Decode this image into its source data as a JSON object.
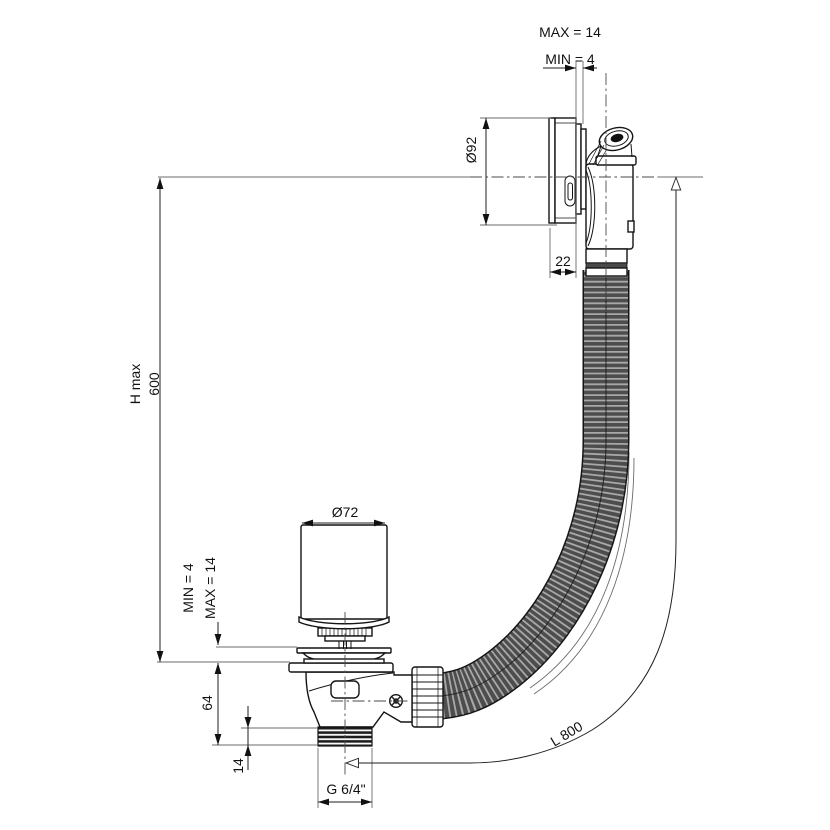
{
  "drawing": {
    "type": "technical-dimension-drawing",
    "background": "#ffffff",
    "line_color": "#141414",
    "dimension_line_color": "#1f1f1f",
    "hose_dark_color": "#4d4d4d",
    "hose_rib_color": "#a8a8a8"
  },
  "dimensions": {
    "overflow_wall_max": "MAX = 14",
    "overflow_wall_min": "MIN = 4",
    "overflow_diameter": "Ø92",
    "overflow_depth": "22",
    "height_max_label": "H max",
    "height_max_value": "600",
    "plug_diameter": "Ø72",
    "waste_rim_min": "MIN = 4",
    "waste_rim_max": "MAX = 14",
    "waste_body_height": "64",
    "waste_thread_length": "14",
    "waste_thread_size": "G 6/4\"",
    "hose_length": "L 800"
  }
}
